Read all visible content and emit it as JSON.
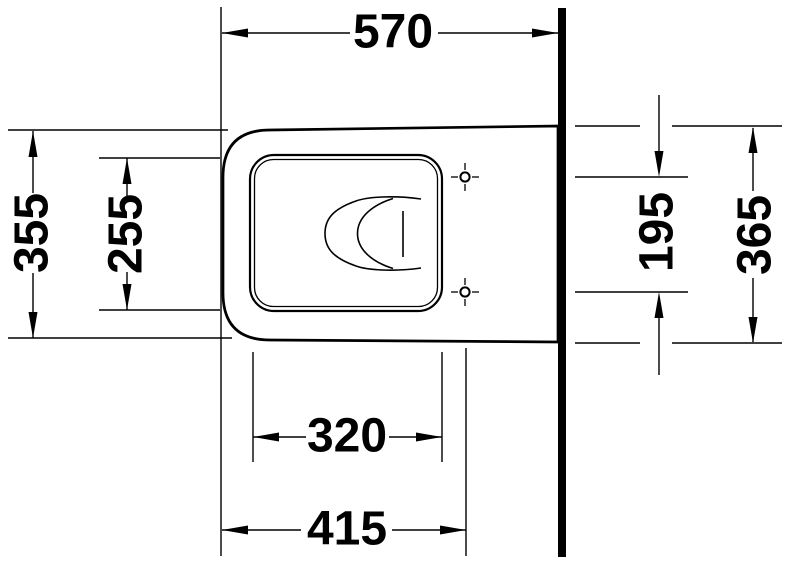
{
  "drawing": {
    "kind": "technical-dimension-drawing",
    "subject": "wall-hung toilet, top view",
    "units": "mm",
    "background_color": "#ffffff",
    "line_color": "#000000",
    "dimensions": {
      "overall_depth_top": {
        "value": "570",
        "orientation": "horizontal",
        "location": "top",
        "measures": "front edge to wall"
      },
      "outer_width_left": {
        "value": "355",
        "orientation": "vertical",
        "location": "left outer",
        "measures": "outer body width"
      },
      "inner_rim_width_left": {
        "value": "255",
        "orientation": "vertical",
        "location": "left inner",
        "measures": "inner rim opening width"
      },
      "hole_spacing_right": {
        "value": "195",
        "orientation": "vertical",
        "location": "right inner",
        "measures": "fixing hole spacing"
      },
      "wall_side_width_right": {
        "value": "365",
        "orientation": "vertical",
        "location": "right outer",
        "measures": "body width at wall"
      },
      "rim_length_bottom": {
        "value": "320",
        "orientation": "horizontal",
        "location": "bottom inner",
        "measures": "inner rim opening length"
      },
      "hole_offset_bottom": {
        "value": "415",
        "orientation": "horizontal",
        "location": "bottom outer",
        "measures": "front edge to fixing holes"
      }
    },
    "features": {
      "wall": "thick vertical wall line at right",
      "fixing_holes": "2 crosshair fixing points",
      "bowl": "nested C-shaped water outline with outlet line"
    }
  }
}
